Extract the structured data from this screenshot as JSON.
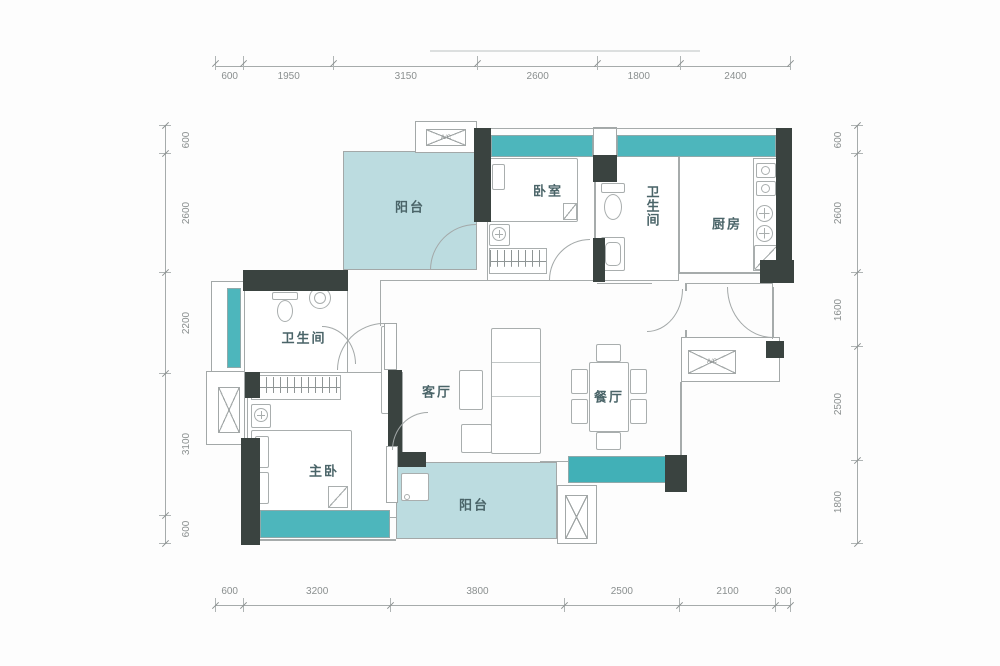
{
  "rooms": {
    "balcony_top": {
      "label": "阳台"
    },
    "bedroom": {
      "label": "卧室"
    },
    "bathroom_top": {
      "label": "卫生间"
    },
    "kitchen": {
      "label": "厨房"
    },
    "living": {
      "label": "客厅"
    },
    "dining": {
      "label": "餐厅"
    },
    "bathroom_main": {
      "label": "卫生间"
    },
    "master_bedroom": {
      "label": "主卧"
    },
    "balcony_bottom": {
      "label": "阳台"
    }
  },
  "annotations": {
    "ac_label": "A/C"
  },
  "dimensions_mm": {
    "top": [
      600,
      1950,
      3150,
      2600,
      1800,
      2400
    ],
    "bottom": [
      600,
      3200,
      3800,
      2500,
      2100,
      300
    ],
    "left": [
      600,
      2600,
      2200,
      3100,
      600
    ],
    "right": [
      600,
      2600,
      1600,
      2500,
      1800
    ]
  },
  "colors": {
    "wall": "#3a4340",
    "window_band": "#4db6bc",
    "balcony_fill": "#bcdce0",
    "line": "#a6abab",
    "label_text": "#4a6468",
    "dimension_text": "#8a8f8f"
  }
}
